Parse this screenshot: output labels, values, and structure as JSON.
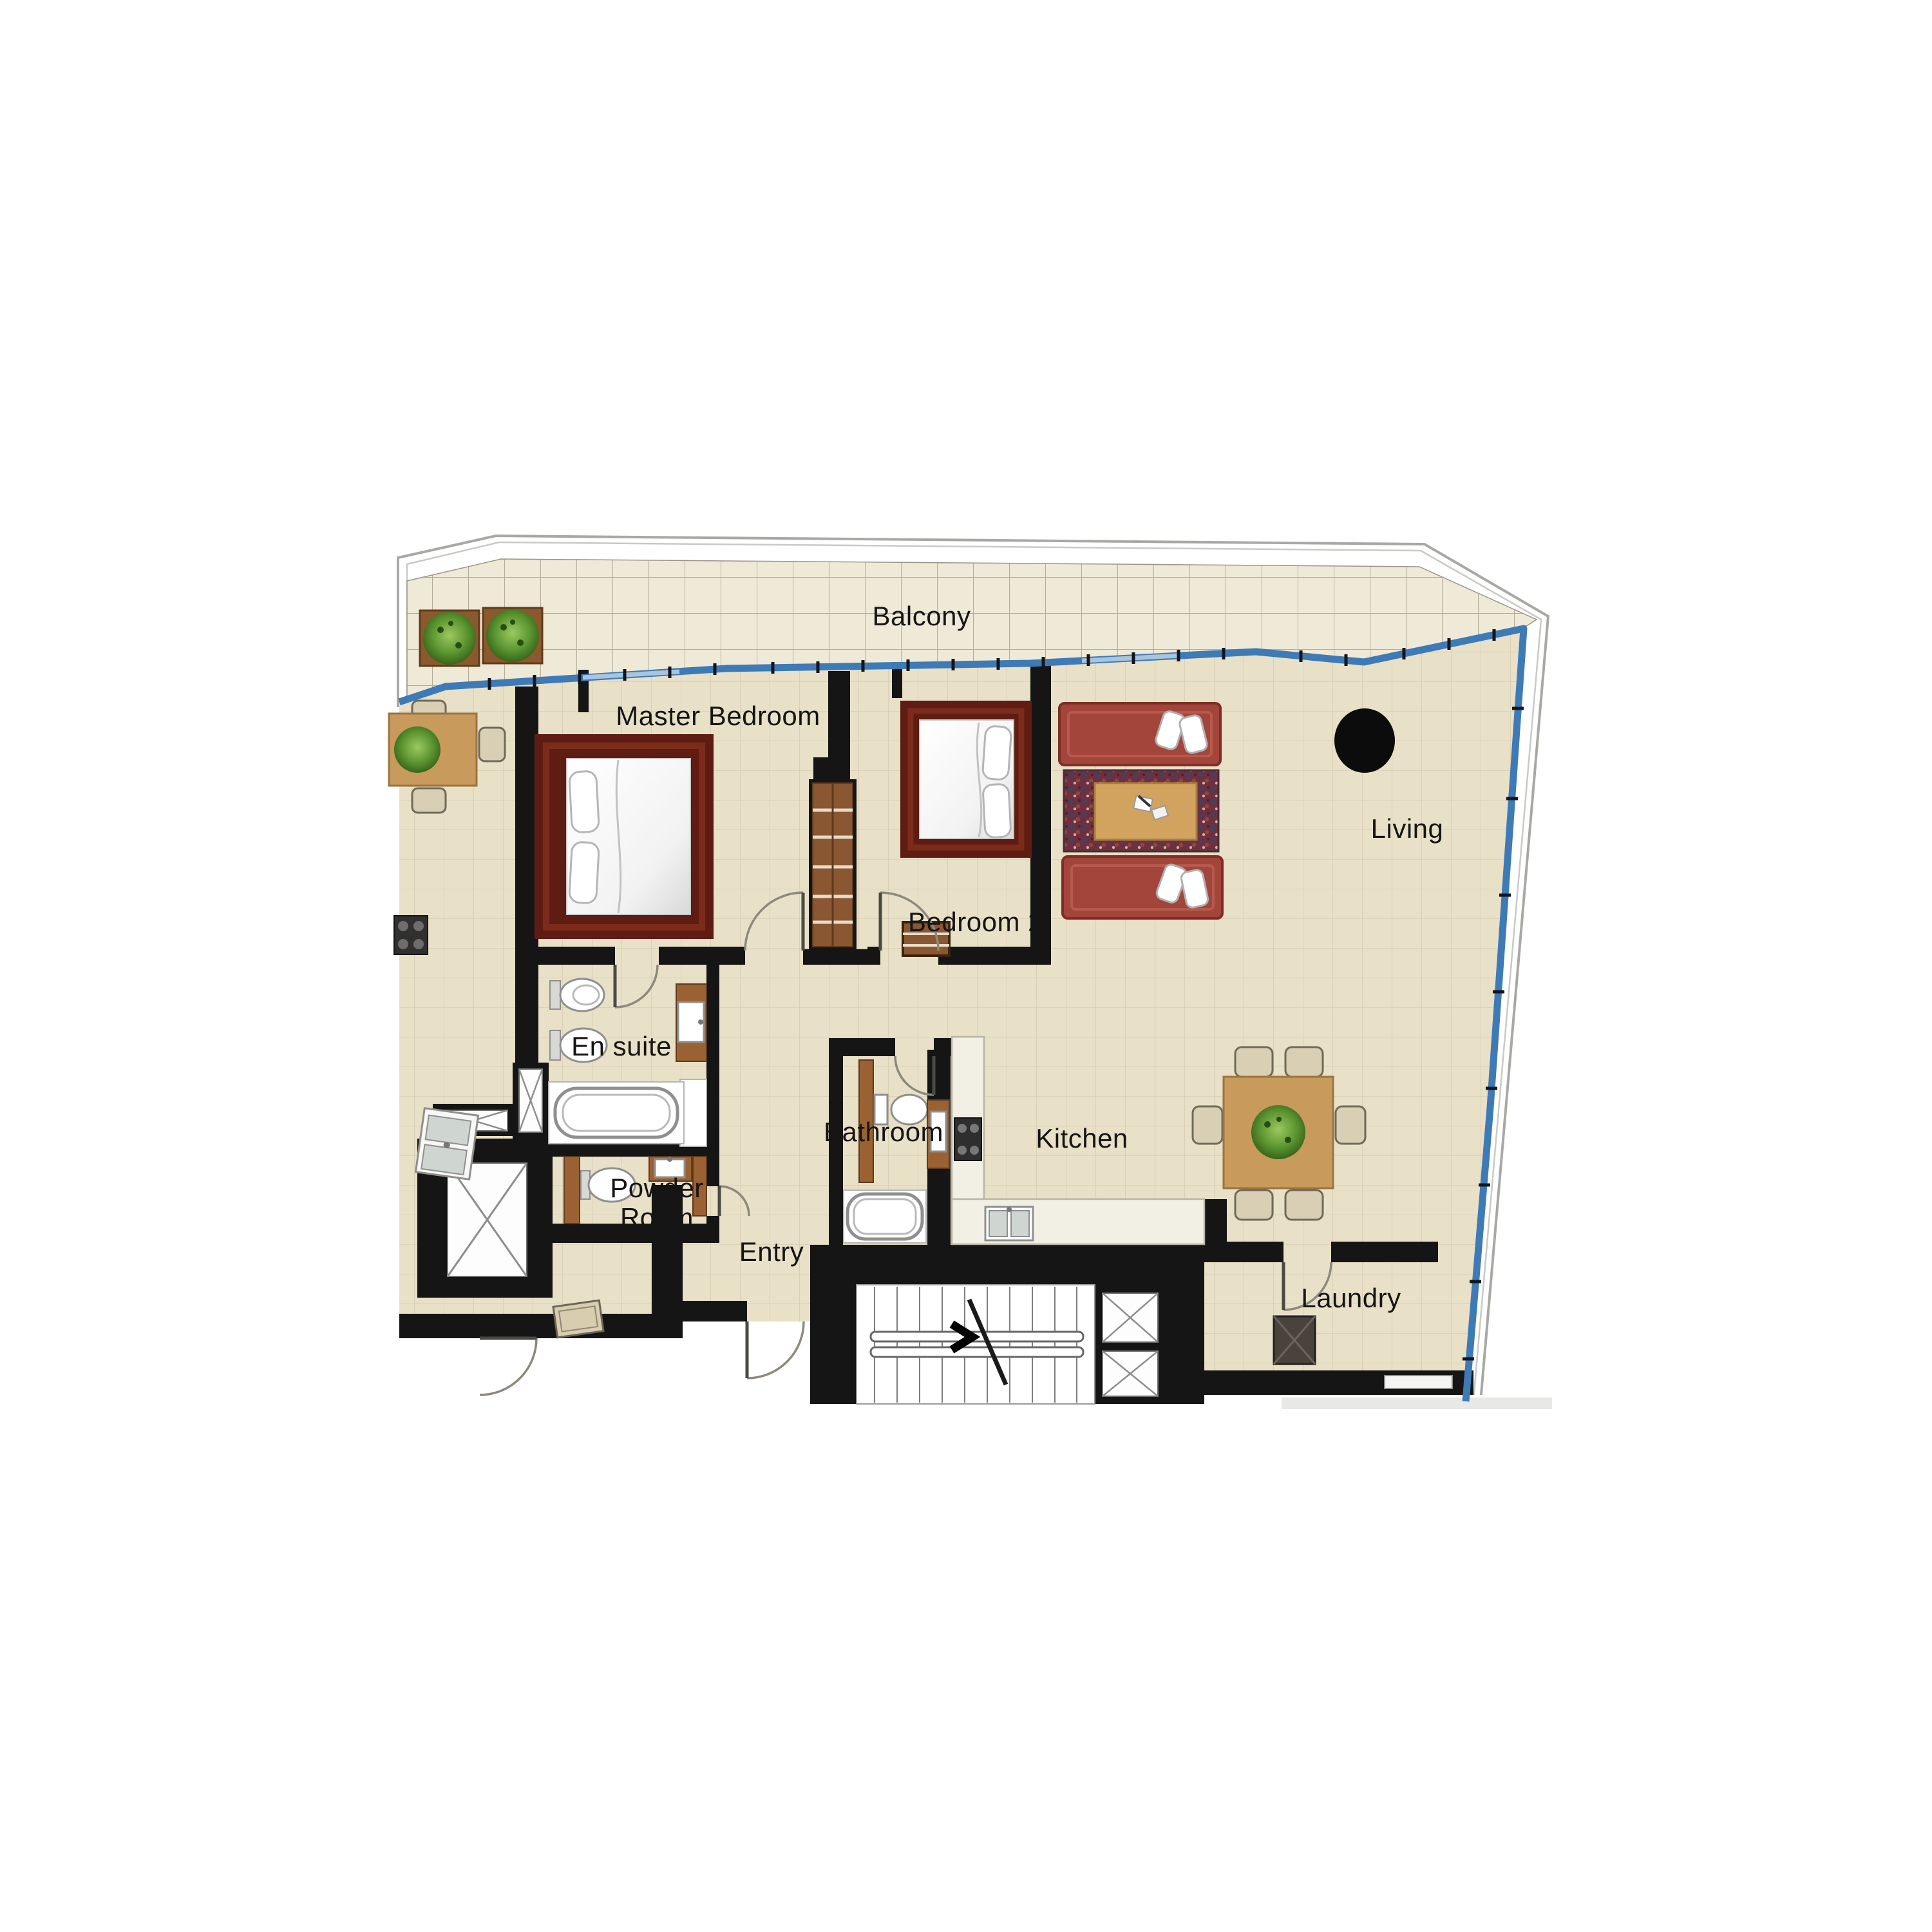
{
  "document": {
    "type": "apartment-floor-plan"
  },
  "labels": {
    "balcony": "Balcony",
    "master_bedroom": "Master Bedroom",
    "bedroom_2": "Bedroom 2",
    "living": "Living",
    "en_suite": "En suite",
    "bathroom": "Bathroom",
    "kitchen": "Kitchen",
    "powder_room_line1": "Powder",
    "powder_room_line2": "Room",
    "entry": "Entry",
    "laundry": "Laundry"
  },
  "colors": {
    "interior_floor": "#e9e0c8",
    "floor_grid": "#d8cdb2",
    "balcony_floor": "#efe9d7",
    "balcony_grid": "#b3ae97",
    "wall": "#151515",
    "balustrade_blue": "#3e7ab6",
    "building_outline": "#a8a8a4",
    "bed_frame": "#5e1c12",
    "sofa": "#a3453a",
    "rug": "#6e3040",
    "wood_cabinet": "#8a5733",
    "table_wood": "#c89a5c",
    "kitchen_counter": "#f2efe4",
    "plant_green": "#4e7d22",
    "fixture_white": "#ffffff"
  },
  "furniture_icons": [
    "double-bed-icon",
    "sofa-icon",
    "rug-icon",
    "coffee-table-icon",
    "dining-table-icon",
    "dining-chair-icon",
    "plant-icon",
    "planter-box-icon",
    "bathtub-icon",
    "toilet-icon",
    "bidet-icon",
    "vanity-basin-icon",
    "cooktop-icon",
    "double-sink-icon",
    "wardrobe-icon",
    "washer-icon",
    "stairs-icon",
    "elevator-icon",
    "structural-column-icon",
    "console-table-icon",
    "door-swing-icon"
  ]
}
